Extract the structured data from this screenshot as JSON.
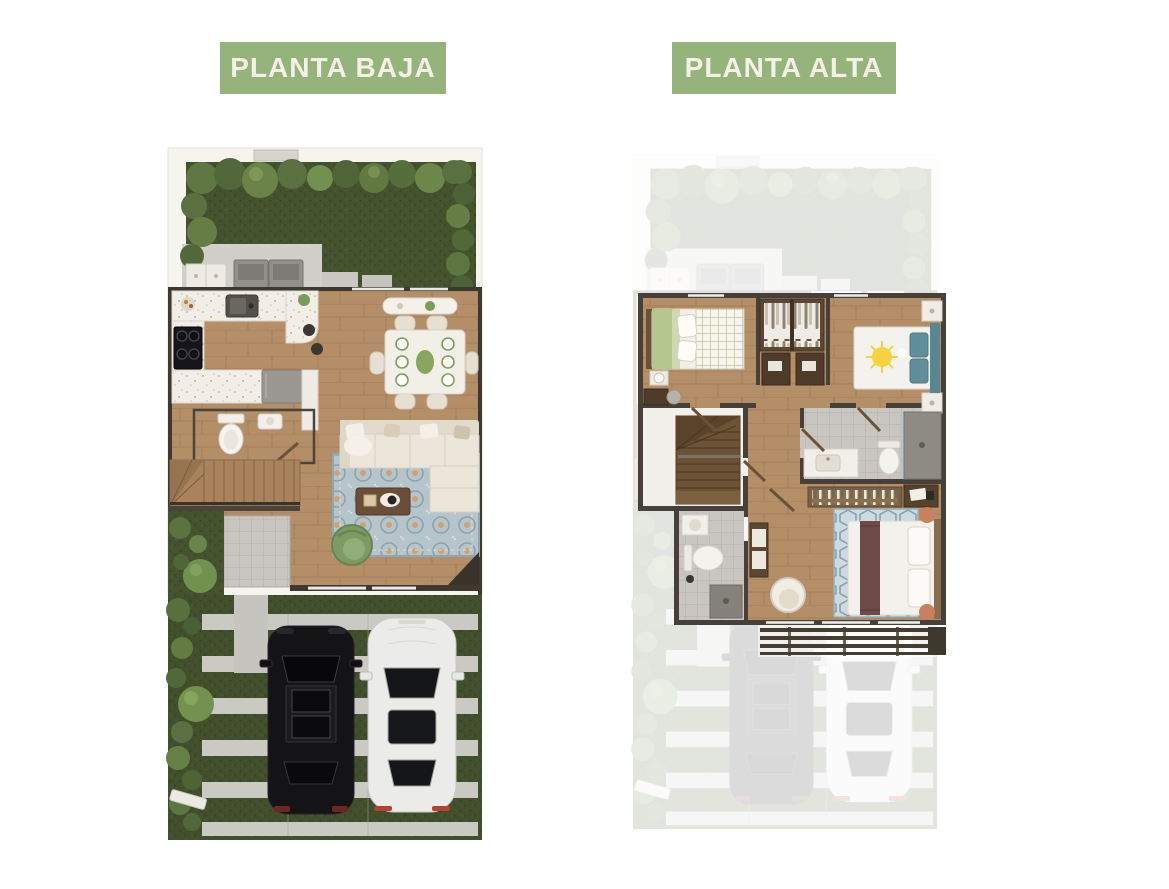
{
  "page": {
    "background_color": "#ffffff"
  },
  "badges": {
    "left": {
      "label": "PLANTA BAJA"
    },
    "right": {
      "label": "PLANTA ALTA"
    }
  },
  "ground_floor": {
    "title": "PLANTA BAJA",
    "areas": [
      "back-garden",
      "laundry-patio",
      "kitchen",
      "dining-area",
      "half-bathroom",
      "staircase",
      "entry-walkway",
      "living-room",
      "side-yard",
      "front-yard-driveway"
    ],
    "objects": [
      "hedges",
      "trees",
      "washer-dryer",
      "laundry-sink",
      "cooktop",
      "kitchen-sink",
      "refrigerator",
      "bar-stools",
      "console-bench",
      "dining-table-6-chairs",
      "toilet",
      "wall-sink",
      "l-shaped-sofa",
      "ornate-area-rug",
      "coffee-table",
      "green-swivel-armchair",
      "open-front-door",
      "paver-strips",
      "black-suv",
      "white-sedan",
      "gate-post"
    ]
  },
  "upper_floor": {
    "title": "PLANTA ALTA",
    "areas": [
      "bedroom-left",
      "shared-closets",
      "bedroom-right",
      "hallway",
      "staircase",
      "bathroom",
      "second-bathroom",
      "master-bedroom",
      "balcony-pergola"
    ],
    "objects": [
      "bed-green-checkered",
      "nightstand-lamp",
      "desk-with-chair",
      "wardrobe-clothes",
      "desks-with-laptops",
      "bed-sun-duvet",
      "teal-headboard",
      "nightstands",
      "vanity",
      "toilet",
      "shower",
      "clothes-rack",
      "writing-desk",
      "hex-pattern-rug",
      "bed-maroon-runner",
      "round-cushions",
      "armchair",
      "dresser",
      "pergola-beams"
    ],
    "ghosted_ground_floor_visible": true
  },
  "colors": {
    "page_bg": "#ffffff",
    "badge_bg": "#95b47b",
    "badge_text": "#f4f1e6",
    "wall_dark": "#3f3830",
    "wood_floor": "#b38e67",
    "garden_grass": "#45522e",
    "paver_gray": "#cbc9c4",
    "terrazzo": "#f1eee7",
    "sofa_cream": "#ece6da",
    "rug_blue": "#b6c5cb",
    "accent_orange": "#d89a57",
    "armchair_green": "#7e9b66",
    "teal_headboard": "#578792",
    "maroon_runner": "#6e4b49",
    "suv_black": "#141417",
    "sedan_white": "#ebebe9"
  }
}
